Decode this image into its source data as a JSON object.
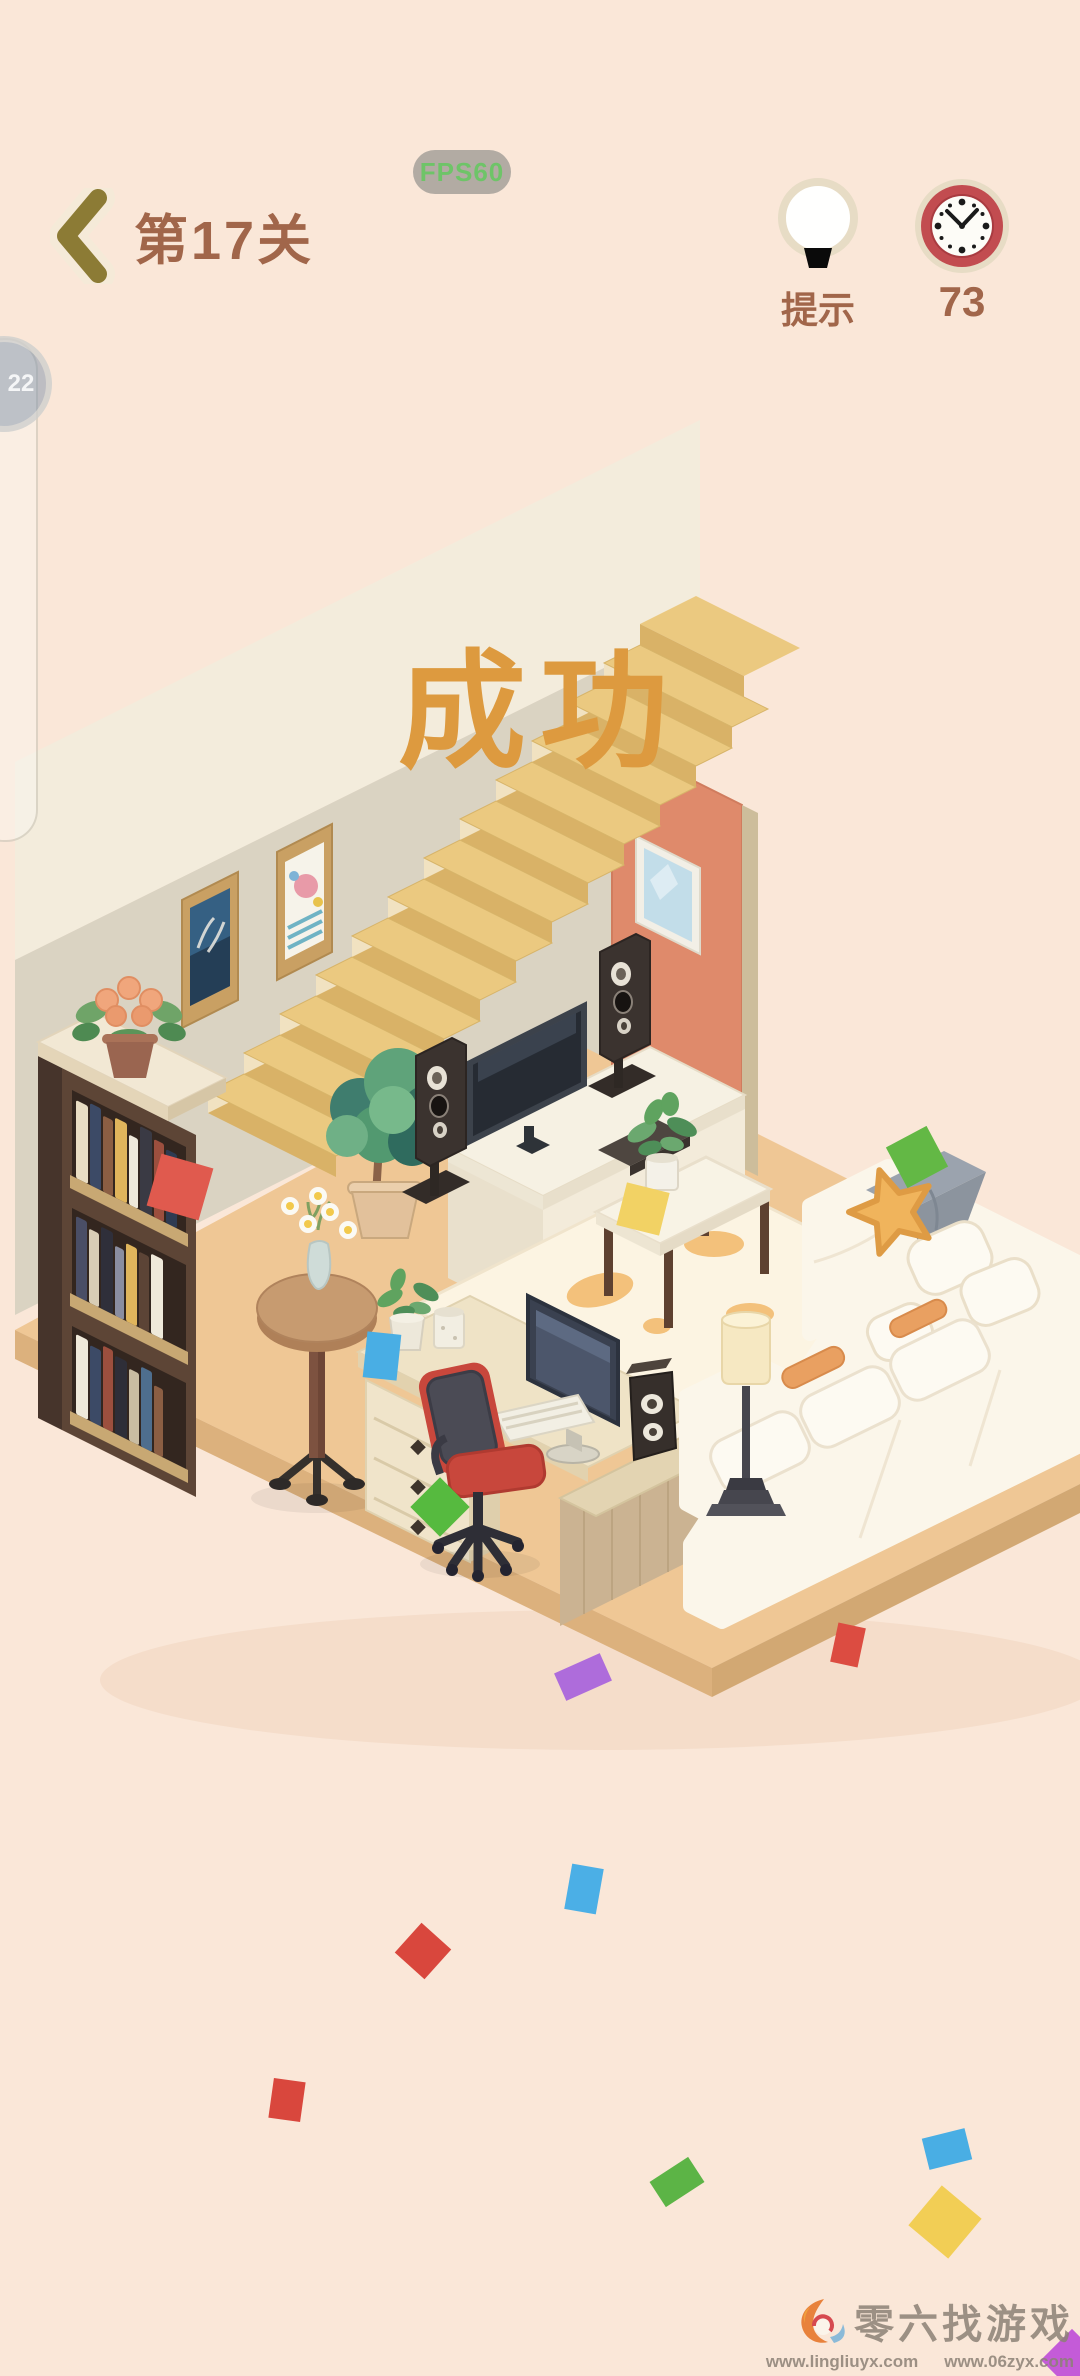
{
  "header": {
    "level_label": "第17关",
    "fps_badge": "FPS60",
    "hint_label": "提示",
    "timer_value": "73"
  },
  "banner": {
    "success_text": "成功"
  },
  "side_widget": {
    "badge_value": "22"
  },
  "watermark": {
    "site_name": "零六找游戏",
    "url_left": "www.lingliuyx.com",
    "url_right": "www.06zyx.com"
  },
  "colors": {
    "background": "#FAE7D8",
    "title_brown": "#A1664A",
    "success_orange": "#DD9A3F",
    "fps_green": "#6EC468",
    "wall_cream": "#F3ECDC",
    "wall_gray": "#DAD3C2",
    "floor_tan": "#EFC795",
    "door_terracotta": "#DF8A6B",
    "stair_tread": "#EBC980",
    "stair_riser": "#D9B267",
    "chair_red": "#C8473C",
    "sofa_white": "#FBF6EA",
    "pillow_yellow": "#F0B45C",
    "blanket_gray": "#9BA3AE"
  },
  "confetti": [
    {
      "x": 180,
      "y": 1187,
      "w": 54,
      "h": 54,
      "rot": 16,
      "color": "#E05A4E"
    },
    {
      "x": 917,
      "y": 1157,
      "w": 46,
      "h": 46,
      "rot": -28,
      "color": "#63B845"
    },
    {
      "x": 643,
      "y": 1209,
      "w": 44,
      "h": 44,
      "rot": 14,
      "color": "#F2D264"
    },
    {
      "x": 382,
      "y": 1356,
      "w": 34,
      "h": 46,
      "rot": 6,
      "color": "#49AEE4"
    },
    {
      "x": 440,
      "y": 1507,
      "w": 42,
      "h": 42,
      "rot": 45,
      "color": "#56BA3F"
    },
    {
      "x": 583,
      "y": 1677,
      "w": 50,
      "h": 30,
      "rot": -24,
      "color": "#AE6CDB"
    },
    {
      "x": 848,
      "y": 1645,
      "w": 28,
      "h": 40,
      "rot": 12,
      "color": "#DC4C41"
    },
    {
      "x": 584,
      "y": 1889,
      "w": 32,
      "h": 46,
      "rot": 10,
      "color": "#4BAFE6"
    },
    {
      "x": 423,
      "y": 1951,
      "w": 40,
      "h": 40,
      "rot": 42,
      "color": "#D9473D"
    },
    {
      "x": 287,
      "y": 2100,
      "w": 32,
      "h": 40,
      "rot": 8,
      "color": "#D9473D"
    },
    {
      "x": 677,
      "y": 2182,
      "w": 46,
      "h": 30,
      "rot": -33,
      "color": "#5CB446"
    },
    {
      "x": 947,
      "y": 2149,
      "w": 44,
      "h": 32,
      "rot": -14,
      "color": "#49AEE4"
    },
    {
      "x": 945,
      "y": 2222,
      "w": 52,
      "h": 52,
      "rot": 40,
      "color": "#F2CE55"
    },
    {
      "x": 1072,
      "y": 2360,
      "w": 44,
      "h": 44,
      "rot": 45,
      "color": "#C45BD8"
    }
  ]
}
